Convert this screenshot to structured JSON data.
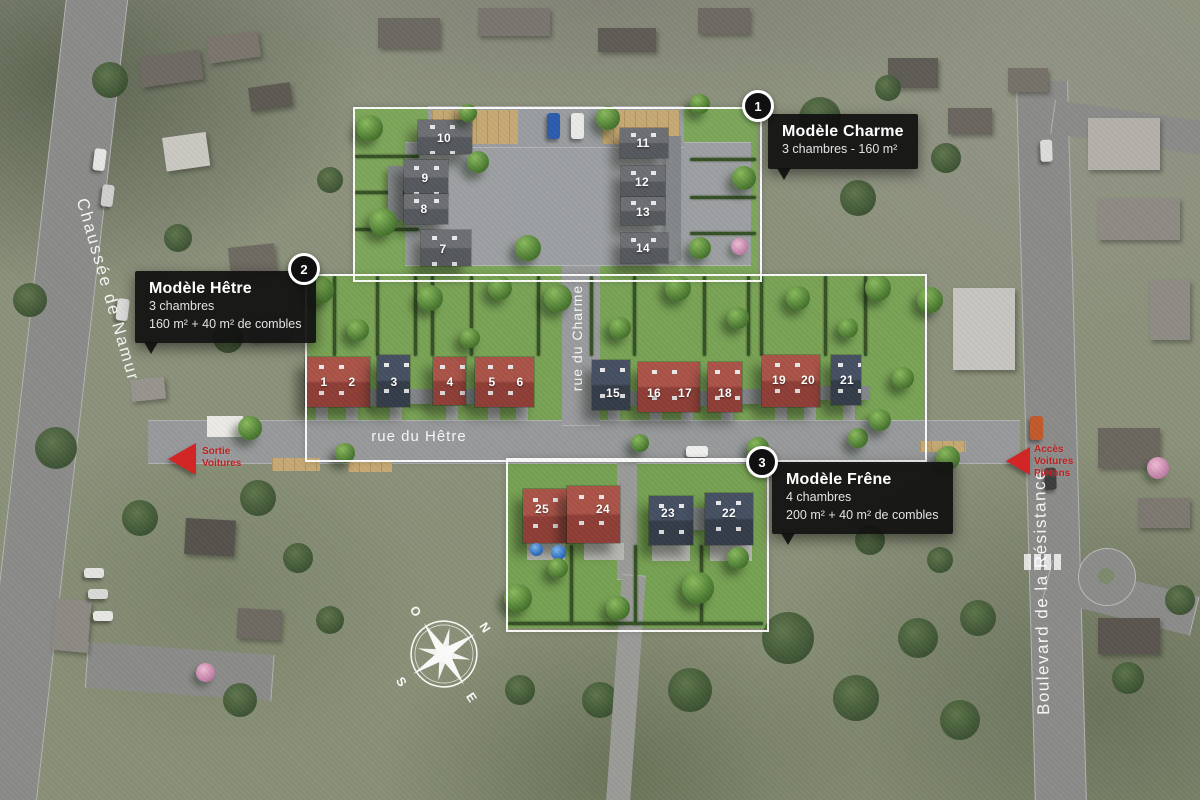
{
  "callouts": [
    {
      "badge": "1",
      "title": "Modèle Charme",
      "lines": [
        "3 chambres - 160 m²"
      ]
    },
    {
      "badge": "2",
      "title": "Modèle Hêtre",
      "lines": [
        "3 chambres",
        "160 m² + 40 m² de combles"
      ]
    },
    {
      "badge": "3",
      "title": "Modèle Frêne",
      "lines": [
        "4 chambres",
        "200 m² + 40 m² de combles"
      ]
    }
  ],
  "streets": {
    "chaussee": "Chaussée de Namur",
    "charme": "rue du Charme",
    "hetre": "rue du Hêtre",
    "boulevard": "Boulevard de la Résistance"
  },
  "access": {
    "exit": "Sortie\nVoitures",
    "entry": "Accès\nVoitures\nPiétons"
  },
  "compass": {
    "north": "N",
    "east": "E",
    "south": "S",
    "west": "O"
  },
  "palette": {
    "roof_gray": "#63666a",
    "roof_red": "#a04a40",
    "roof_blue": "#3d4553",
    "zone_border": "#ffffff",
    "accent_red": "#d22626",
    "callout_bg": "#101010"
  },
  "houses": [
    {
      "num": "1",
      "x": 324,
      "y": 382
    },
    {
      "num": "2",
      "x": 352,
      "y": 382
    },
    {
      "num": "3",
      "x": 394,
      "y": 382
    },
    {
      "num": "4",
      "x": 450,
      "y": 382
    },
    {
      "num": "5",
      "x": 492,
      "y": 382
    },
    {
      "num": "6",
      "x": 520,
      "y": 382
    },
    {
      "num": "7",
      "x": 443,
      "y": 249
    },
    {
      "num": "8",
      "x": 424,
      "y": 209
    },
    {
      "num": "9",
      "x": 425,
      "y": 178
    },
    {
      "num": "10",
      "x": 444,
      "y": 138
    },
    {
      "num": "11",
      "x": 643,
      "y": 143
    },
    {
      "num": "12",
      "x": 642,
      "y": 182
    },
    {
      "num": "13",
      "x": 643,
      "y": 212
    },
    {
      "num": "14",
      "x": 643,
      "y": 248
    },
    {
      "num": "15",
      "x": 613,
      "y": 393
    },
    {
      "num": "16",
      "x": 654,
      "y": 393
    },
    {
      "num": "17",
      "x": 685,
      "y": 393
    },
    {
      "num": "18",
      "x": 725,
      "y": 393
    },
    {
      "num": "19",
      "x": 779,
      "y": 380
    },
    {
      "num": "20",
      "x": 808,
      "y": 380
    },
    {
      "num": "21",
      "x": 847,
      "y": 380
    },
    {
      "num": "22",
      "x": 729,
      "y": 513
    },
    {
      "num": "23",
      "x": 668,
      "y": 513
    },
    {
      "num": "24",
      "x": 603,
      "y": 509
    },
    {
      "num": "25",
      "x": 542,
      "y": 509
    }
  ]
}
